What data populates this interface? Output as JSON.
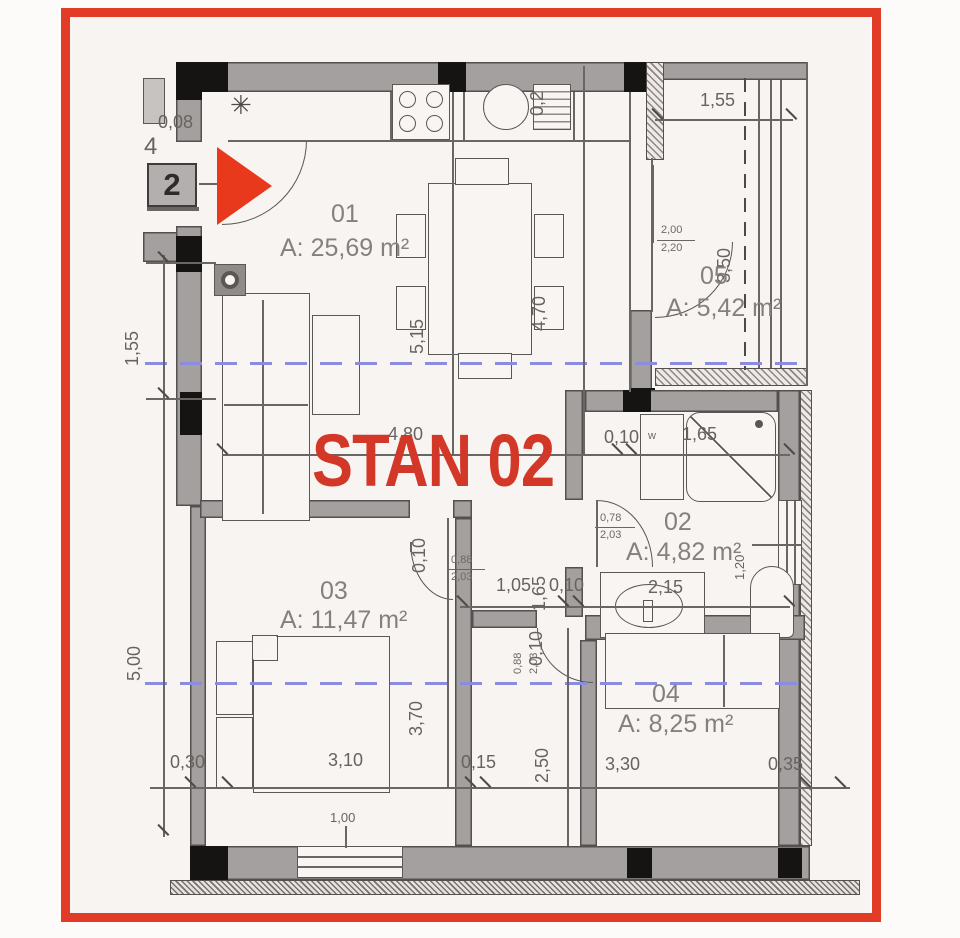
{
  "plan": {
    "stan_title": "STAN 02",
    "unit_number": "2",
    "side_number": "4",
    "kitchen_symbol": "✳",
    "washer_mark": "w",
    "rooms": [
      {
        "number": "01",
        "area": "A: 25,69 m²"
      },
      {
        "number": "02",
        "area": "A: 4,82 m²"
      },
      {
        "number": "03",
        "area": "A: 11,47 m²"
      },
      {
        "number": "04",
        "area": "A: 8,25 m²"
      },
      {
        "number": "05",
        "area": "A: 5,42 m²"
      }
    ],
    "dims": [
      {
        "label": "0,08"
      },
      {
        "label": "1,55"
      },
      {
        "label": "3,50"
      },
      {
        "label": "0,2"
      },
      {
        "label": "5,15"
      },
      {
        "label": "4,70"
      },
      {
        "label": "4,80"
      },
      {
        "label": "0,10"
      },
      {
        "label": "1,65"
      },
      {
        "label": "0,10"
      },
      {
        "label": "1,65"
      },
      {
        "label": "1,05"
      },
      {
        "label": "0,10"
      },
      {
        "label": "2,15"
      },
      {
        "label": "0,10"
      },
      {
        "label": "3,70"
      },
      {
        "label": "2,50"
      },
      {
        "label": "0,30"
      },
      {
        "label": "3,10"
      },
      {
        "label": "0,15"
      },
      {
        "label": "3,30"
      },
      {
        "label": "0,35"
      },
      {
        "label": "1,55"
      },
      {
        "label": "5,00"
      },
      {
        "label": "1,20"
      },
      {
        "label": "1,00"
      }
    ],
    "doors": [
      {
        "w": "0,78",
        "h": "2,03"
      },
      {
        "w": "0,88",
        "h": "2,03"
      },
      {
        "w": "0,88",
        "h": "2,03"
      },
      {
        "w": "2,00",
        "h": "2,20"
      }
    ],
    "colors": {
      "frame_red": "#e23b27",
      "accent_red": "#d23728",
      "section_blue": "#8b8bdf"
    }
  }
}
